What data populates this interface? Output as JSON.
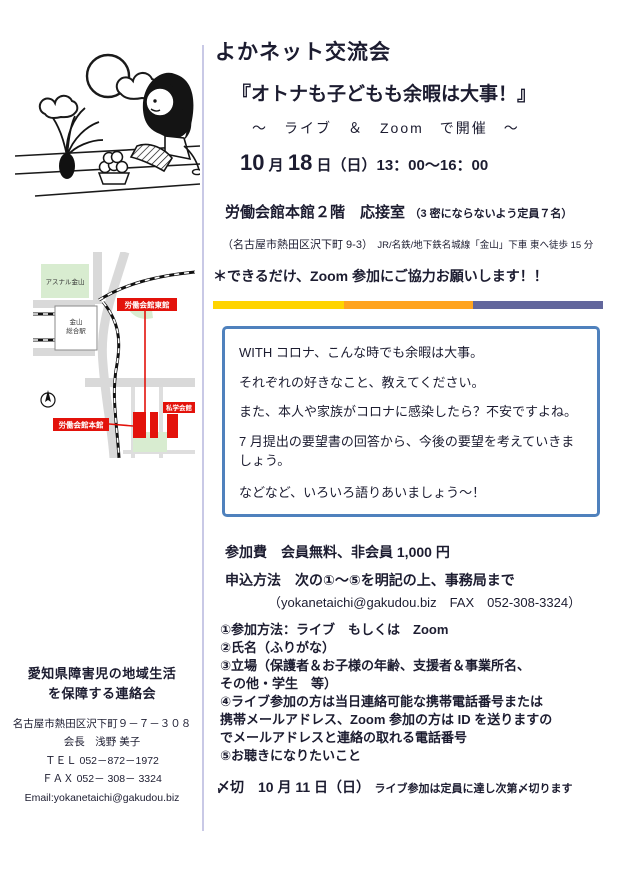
{
  "right": {
    "title": "よかネット交流会",
    "subtitle": "『オトナも子どもも余暇は大事！』",
    "format_line": "～　ライブ　＆　Zoom　で開催　～",
    "date": {
      "month_num": "10",
      "month_label": "月",
      "day_num": "18",
      "rest": "日（日）13：00～16：00"
    },
    "venue": {
      "name": "労働会館本館２階　応接室",
      "capacity_note": "（3 密にならないよう定員７名）"
    },
    "access": {
      "address": "（名古屋市熱田区沢下町 9-3）",
      "route": "JR/名鉄/地下鉄名城線「金山」下車 東へ徒歩 15 分"
    },
    "zoom_request": "＊できるだけ、Zoom 参加にご協力お願いします！！",
    "divider_colors": [
      "#ffd400",
      "#ffa420",
      "#62669c"
    ],
    "box_border_color": "#4f81bd",
    "box_lines": [
      "WITH コロナ、こんな時でも余暇は大事。",
      "それぞれの好きなこと、教えてください。",
      "また、本人や家族がコロナに感染したら？不安ですよね。",
      "7 月提出の要望書の回答から、今後の要望を考えていきましょう。",
      "などなど、いろいろ語りあいましょう～！"
    ],
    "fee_line": "参加費　会員無料、非会員 1,000 円",
    "apply_heading": "申込方法　次の①～⑤を明記の上、事務局まで",
    "apply_contact": "（yokanetaichi@gakudou.biz　FAX　052-308-3324）",
    "apply_items": [
      "①参加方法：ライブ　もしくは　Zoom",
      "②氏名（ふりがな）",
      "③立場（保護者＆お子様の年齢、支援者＆事業所名、",
      "その他・学生　等）",
      "④ライブ参加の方は当日連絡可能な携帯電話番号または",
      "携帯メールアドレス、Zoom 参加の方は ID を送りますの",
      "でメールアドレスと連絡の取れる電話番号",
      "⑤お聴きになりたいこと"
    ],
    "deadline": {
      "label": "〆切　10 月 11 日（日）",
      "note": "ライブ参加は定員に達し次第〆切ります"
    }
  },
  "left": {
    "map": {
      "accent_red": "#e3120b",
      "labels": {
        "east_hall": "労働会館東館",
        "main_hall": "労働会館本館",
        "shigaku_hall": "私学会館",
        "station_line1": "金山",
        "station_line2": "総合駅",
        "asunal": "アスナル金山"
      }
    },
    "org": {
      "name_line1": "愛知県障害児の地域生活",
      "name_line2": "を保障する連絡会",
      "address": "名古屋市熱田区沢下町９－７－３０８",
      "chairman": "会長　浅野 美子",
      "tel": "ＴＥＬ 052－872－1972",
      "fax": "ＦＡＸ 052－ 308－ 3324",
      "email": "Email:yokanetaichi@gakudou.biz"
    }
  }
}
